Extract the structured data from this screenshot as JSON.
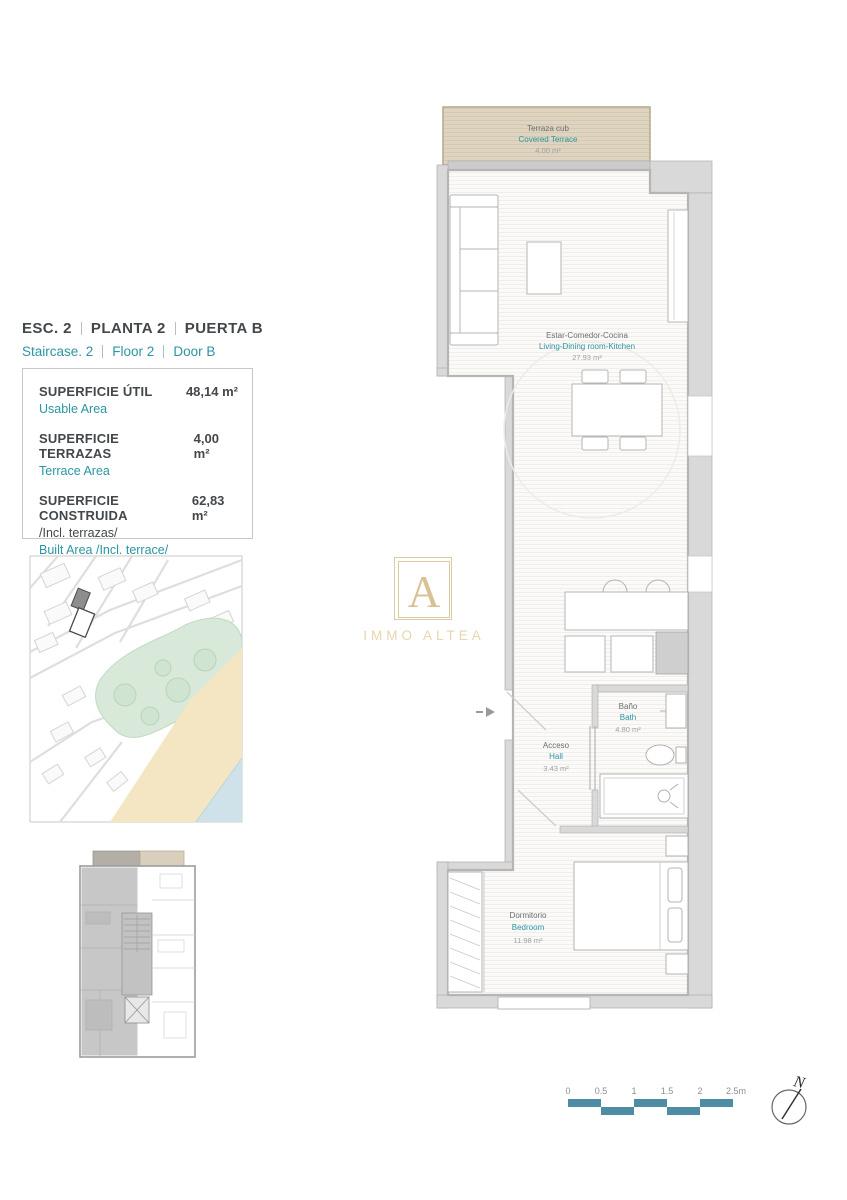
{
  "header": {
    "es": [
      "ESC. 2",
      "PLANTA 2",
      "PUERTA B"
    ],
    "en": [
      "Staircase. 2",
      "Floor 2",
      "Door B"
    ]
  },
  "areas": {
    "rows": [
      {
        "es": "SUPERFICIE ÚTIL",
        "en": "Usable Area",
        "value": "48,14 m²"
      },
      {
        "es": "SUPERFICIE TERRAZAS",
        "en": "Terrace Area",
        "value": "4,00 m²"
      },
      {
        "es": "SUPERFICIE CONSTRUIDA",
        "es2": "/Incl. terrazas/",
        "en": "Built Area /Incl. terrace/",
        "value": "62,83 m²"
      }
    ]
  },
  "logo": {
    "letter": "A",
    "name": "IMMO ALTEA"
  },
  "plan": {
    "rooms": [
      {
        "es": "Terraza cub",
        "en": "Covered Terrace",
        "area": "4.00 m²"
      },
      {
        "es": "Estar-Comedor-Cocina",
        "en": "Living-Dining room-Kitchen",
        "area": "27.93 m²"
      },
      {
        "es": "Baño",
        "en": "Bath",
        "area": "4.80 m²"
      },
      {
        "es": "Acceso",
        "en": "Hall",
        "area": "3.43 m²"
      },
      {
        "es": "Dormitorio",
        "en": "Bedroom",
        "area": "11.98 m²"
      }
    ]
  },
  "scalebar": {
    "ticks": [
      "0",
      "0.5",
      "1",
      "1.5",
      "2",
      "2.5m"
    ]
  },
  "north": {
    "label": "N"
  },
  "colors": {
    "accent_teal": "#2b96a3",
    "dark_text": "#43474b",
    "muted_text": "#9ba1a5",
    "terrace_beige": "#ded4c0",
    "wall_gray": "#d9d9d9",
    "scalebar_teal": "#4e8ca4",
    "map_green": "#d8e9da",
    "map_sand": "#f4e6c2",
    "map_sea": "#cfe2e9",
    "logo_gold": "#d8c193"
  }
}
